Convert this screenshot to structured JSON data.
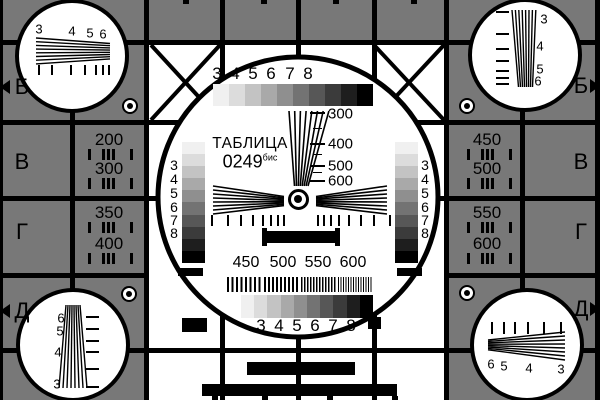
{
  "colors": {
    "background": "#787878",
    "line": "#000000",
    "panel": "#ffffff",
    "grayscale_steps": [
      "#f0f0f0",
      "#dcdcdc",
      "#c3c3c3",
      "#a9a9a9",
      "#8f8f8f",
      "#737373",
      "#575757",
      "#3b3b3b",
      "#1e1e1e",
      "#000000"
    ]
  },
  "title": {
    "name": "ТАБЛИЦА",
    "code": "0249",
    "suffix": "бис"
  },
  "row_markers": {
    "left": [
      {
        "label": "Б",
        "arrow": true
      },
      {
        "label": "В",
        "arrow": false
      },
      {
        "label": "Г",
        "arrow": false
      },
      {
        "label": "Д",
        "arrow": true
      }
    ],
    "right": [
      {
        "label": "Б",
        "arrow": true
      },
      {
        "label": "В",
        "arrow": false
      },
      {
        "label": "Г",
        "arrow": false
      },
      {
        "label": "Д",
        "arrow": true
      }
    ]
  },
  "side_panels": {
    "left_upper": [
      "200",
      "300"
    ],
    "left_lower": [
      "350",
      "400"
    ],
    "right_upper": [
      "450",
      "500"
    ],
    "right_lower": [
      "550",
      "600"
    ]
  },
  "center": {
    "top_scale": [
      "3",
      "4",
      "5",
      "6",
      "7",
      "8"
    ],
    "grayscale_left": [
      "3",
      "4",
      "5",
      "6",
      "7",
      "8"
    ],
    "grayscale_right": [
      "3",
      "4",
      "5",
      "6",
      "7",
      "8"
    ],
    "vertical_scale": [
      "300",
      "400",
      "500",
      "600"
    ],
    "frequency_labels": [
      "450",
      "500",
      "550",
      "600"
    ],
    "bottom_scale": [
      "3",
      "4",
      "5",
      "6",
      "7",
      "8"
    ]
  },
  "corner_circles": {
    "top_left": [
      "3",
      "4",
      "5",
      "6"
    ],
    "top_right": [
      "3",
      "4",
      "5",
      "6"
    ],
    "bottom_left": [
      "6",
      "5",
      "4",
      "3"
    ],
    "bottom_right": [
      "6",
      "5",
      "4",
      "3"
    ]
  }
}
